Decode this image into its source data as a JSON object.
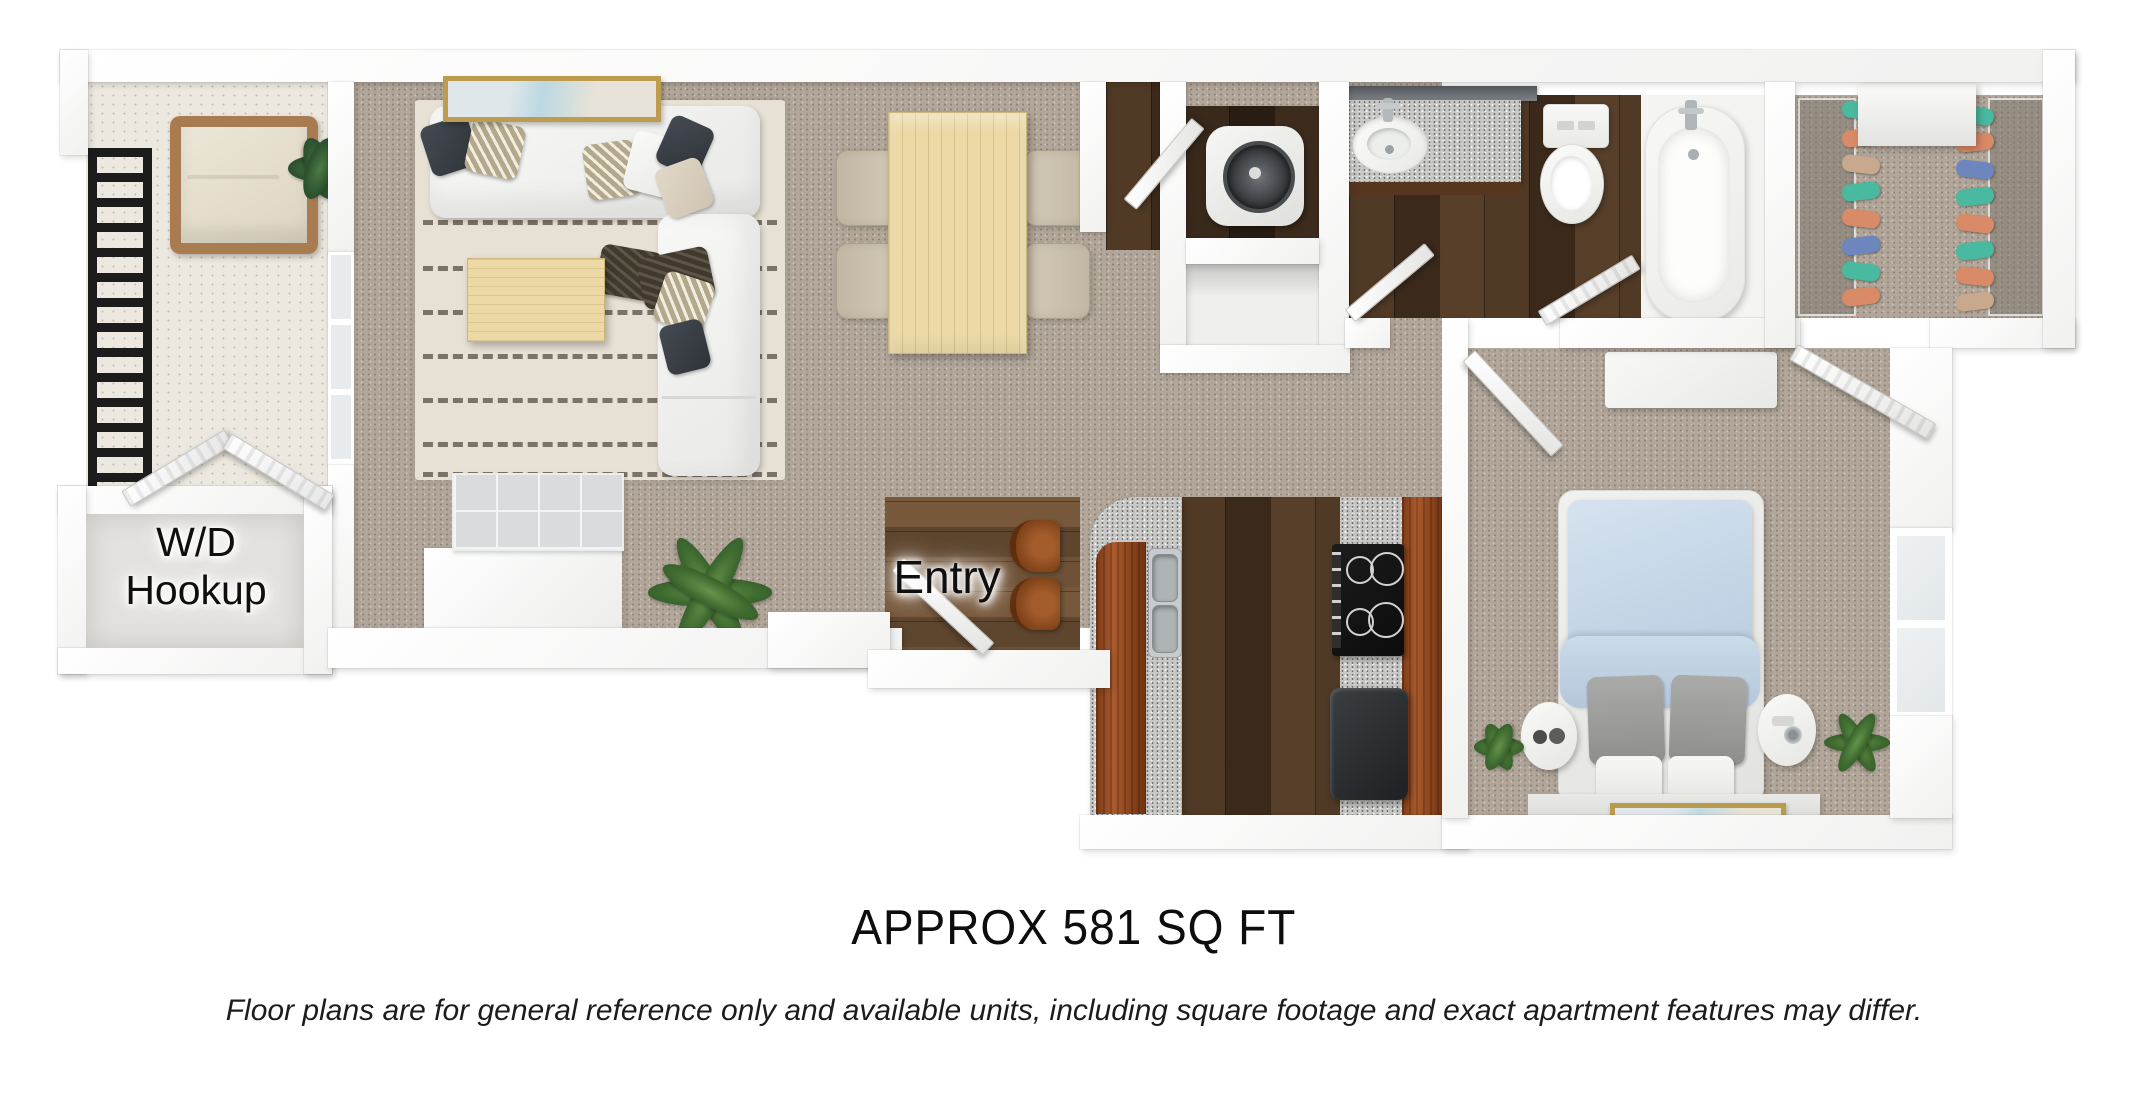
{
  "plan": {
    "labels": {
      "wd_hookup": "W/D Hookup",
      "entry": "Entry"
    },
    "caption": {
      "title": "APPROX 581 SQ FT",
      "disclaimer": "Floor plans are for general reference only and available units, including square footage and exact apartment features may differ."
    },
    "colors": {
      "carpet": "#b1a699",
      "rug": "#e7e0d4",
      "balcony_floor": "#ece8df",
      "wood_dark": "#46321f",
      "wood_entry": "#6d4f33",
      "cabinet_wood": "#94491f",
      "granite": "#c8c8c6",
      "dining_table_wood": "#ecd9a6",
      "duvet_blue": "#c7d8e8",
      "plant_green": "#4c7a3c",
      "railing_black": "#1c1c1c",
      "frame_gold": "#bd9c4f"
    },
    "closet_clothes": [
      "#49b9a0",
      "#d98a66",
      "#c8a98e",
      "#49b9a0",
      "#d98a66",
      "#6d86bd",
      "#49b9a0",
      "#d98a66"
    ]
  }
}
